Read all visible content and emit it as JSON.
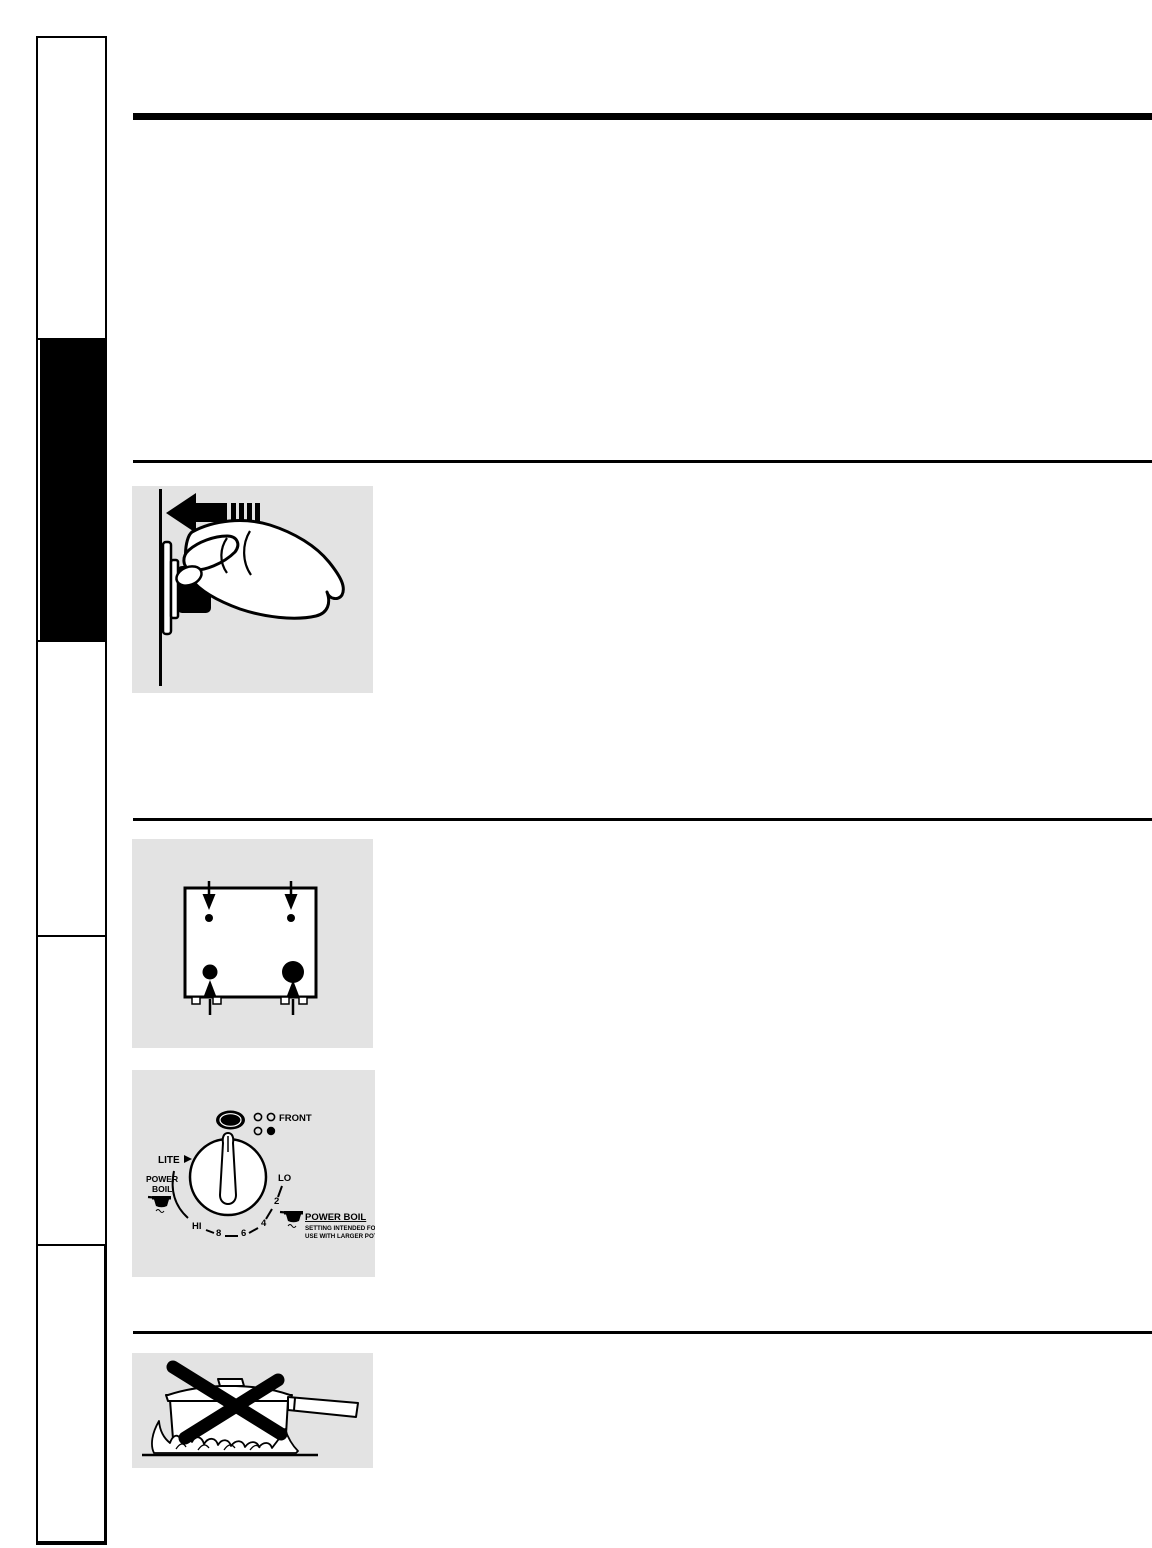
{
  "colors": {
    "page_bg": "#ffffff",
    "ink": "#000000",
    "figure_bg": "#e3e3e3",
    "active_tab_bg": "#000000"
  },
  "sidebar": {
    "tabs": [
      {
        "id": "tab-1",
        "active": false
      },
      {
        "id": "tab-2",
        "active": true
      },
      {
        "id": "tab-3",
        "active": false
      },
      {
        "id": "tab-4",
        "active": false
      },
      {
        "id": "tab-5",
        "active": false
      }
    ]
  },
  "figures": {
    "knob_push": {
      "icon": "hand-pushing-control-knob-with-left-arrow"
    },
    "cooktop": {
      "icon": "cooktop-top-view-four-burners-with-arrows"
    },
    "dial": {
      "icon": "surface-burner-control-knob-dial",
      "off": "OFF",
      "front": "FRONT",
      "lite": "LITE",
      "power_boil_left": [
        "POWER",
        "BOIL"
      ],
      "scale": [
        "HI",
        "8",
        "6",
        "4",
        "2",
        "LO"
      ],
      "power_boil_right_title": "POWER BOIL",
      "power_boil_right_sub": [
        "SETTING INTENDED FOR",
        "USE WITH LARGER POTS"
      ]
    },
    "no_flames_up_sides": {
      "icon": "saucepan-over-flames-crossed-out"
    }
  }
}
